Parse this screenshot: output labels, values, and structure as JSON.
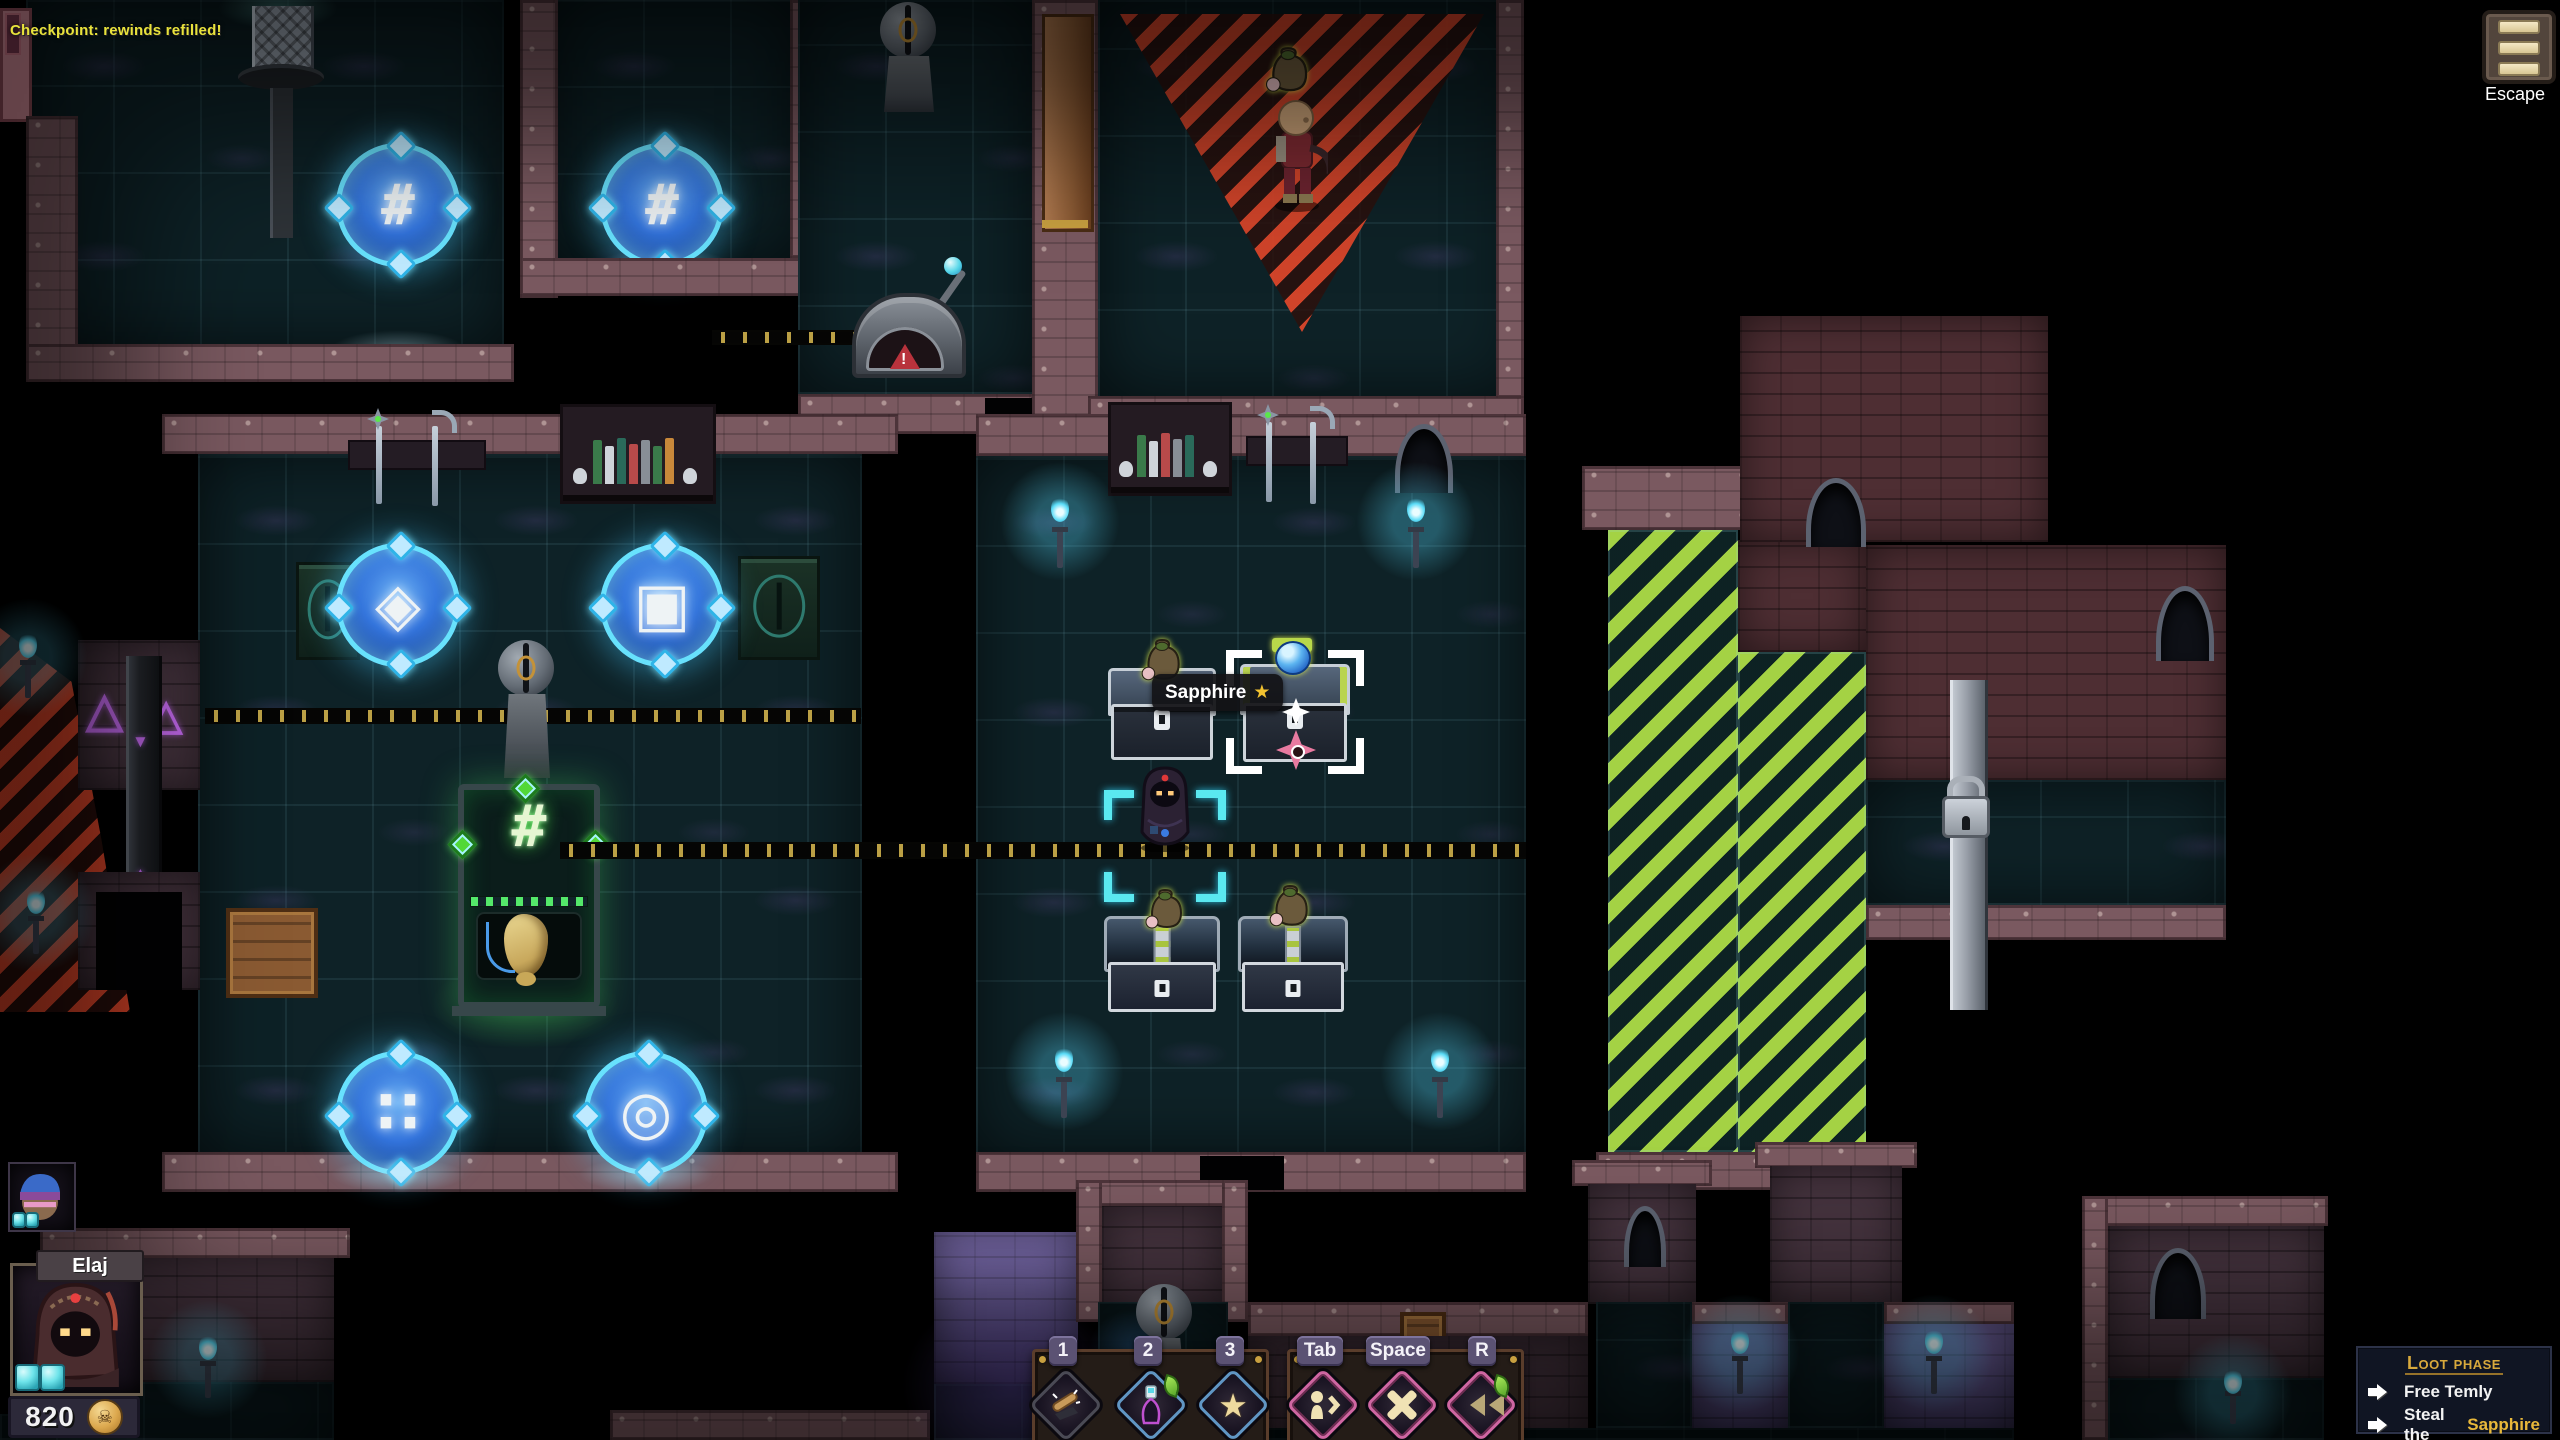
{
  "scene": {
    "checkpoint_toast": "Checkpoint: rewinds refilled!",
    "tooltip": {
      "label": "Sapphire",
      "star_glyph": "★"
    },
    "portal_glyphs": {
      "hash_a": "#",
      "hash_b": "#",
      "diamond": "◈",
      "square": "▣",
      "dots": "∷",
      "ring": "◎"
    },
    "machine_glyph": "#",
    "lever_warning": "!",
    "wall_runes": {
      "triangle_a": "△",
      "triangle_b": "△",
      "track_down": "▼",
      "track_up": "▲"
    }
  },
  "hud": {
    "escape": {
      "label": "Escape"
    },
    "player": {
      "name": "Elaj",
      "gold": "820",
      "coin_glyph": "☠"
    },
    "hotbar": {
      "key_1": "1",
      "key_2": "2",
      "key_3": "3",
      "key_tab": "Tab",
      "key_space": "Space",
      "key_r": "R",
      "star_glyph": "★"
    },
    "objectives": {
      "title": "Loot phase",
      "item_1": "Free Temly",
      "item_2_prefix": "Steal the",
      "item_2_highlight": "Sapphire"
    }
  },
  "colors": {
    "toast_yellow": "#e8e23c",
    "accent_gold": "#d8a93c",
    "objective_highlight": "#e8b83a",
    "portal_blue": "#35c8f0",
    "alert_red": "#e2472a",
    "safe_green": "#a4d244",
    "torch_cyan": "#5adcf8"
  }
}
